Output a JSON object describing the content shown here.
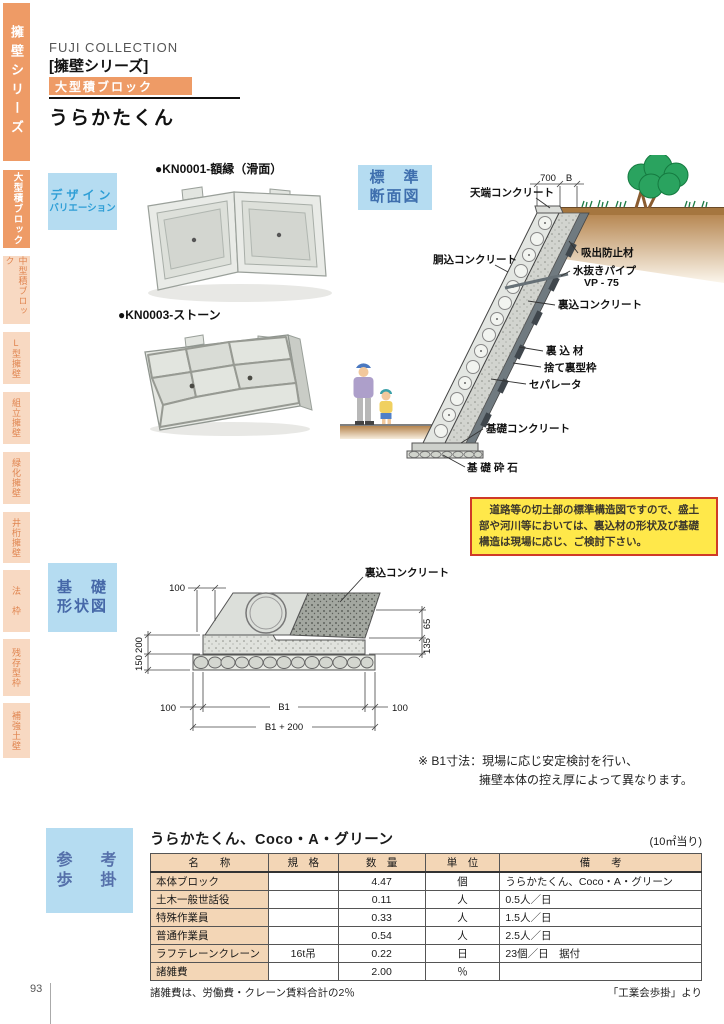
{
  "page": {
    "number": "93"
  },
  "sidebar": {
    "series": "擁壁シリーズ",
    "tabs": [
      {
        "label": "大型積ブロック",
        "active": true
      },
      {
        "label": "中型積ブロック",
        "active": false
      },
      {
        "label": "L型擁壁",
        "active": false
      },
      {
        "label": "組立擁壁",
        "active": false
      },
      {
        "label": "緑化擁壁",
        "active": false
      },
      {
        "label": "井桁擁壁",
        "active": false
      },
      {
        "label": "法　枠",
        "active": false
      },
      {
        "label": "残存型枠",
        "active": false
      },
      {
        "label": "補強土壁",
        "active": false
      }
    ]
  },
  "header": {
    "brand": "FUJI COLLECTION",
    "series": "[擁壁シリーズ]",
    "badge": "大型積ブロック",
    "title": "うらかたくん"
  },
  "design": {
    "label_line1": "デザイン",
    "label_line2": "バリエーション",
    "product1": "●KN0001-額縁（滑面）",
    "product2": "●KN0003-ストーン"
  },
  "cross_section": {
    "label_line1": "標　準",
    "label_line2": "断面図",
    "dims": {
      "top_width": "700",
      "b": "B"
    },
    "labels": {
      "tenba": "天端コンクリート",
      "dokome": "胴込コンクリート",
      "kyushutsu": "吸出防止材",
      "mizunuki": "水抜きパイプ",
      "vp": "VP - 75",
      "urakome_concrete": "裏込コンクリート",
      "urakome_material": "裏 込 材",
      "sute_urakata": "捨て裏型枠",
      "separator": "セパレータ",
      "kiso_concrete": "基礎コンクリート",
      "kiso_saiseki": "基 礎 砕 石"
    },
    "note": "　道路等の切土部の標準構造図ですので、盛土部や河川等においては、裏込材の形状及び基礎構造は現場に応じ、ご検討下さい。"
  },
  "foundation": {
    "label_line1": "基　礎",
    "label_line2": "形状図",
    "labels": {
      "urakome_concrete": "裏込コンクリート"
    },
    "dims": {
      "top100": "100",
      "left200": "200",
      "left150": "150",
      "right65": "65",
      "right135": "135",
      "bottom100L": "100",
      "b1": "B1",
      "bottom100R": "100",
      "b1_200": "B1 + 200"
    },
    "note_line1": "※ B1寸法：現場に応じ安定検討を行い、",
    "note_line2": "擁壁本体の控え厚によって異なります。"
  },
  "reference": {
    "label_line1": "参　考",
    "label_line2": "歩　掛",
    "table": {
      "title": "うらかたくん、Coco・A・グリーン",
      "unit_note": "(10㎡当り)",
      "headers": [
        "名　　称",
        "規　格",
        "数　量",
        "単　位",
        "備　　考"
      ],
      "rows": [
        [
          "本体ブロック",
          "",
          "4.47",
          "個",
          "うらかたくん、Coco・A・グリーン"
        ],
        [
          "土木一般世話役",
          "",
          "0.11",
          "人",
          "0.5人／日"
        ],
        [
          "特殊作業員",
          "",
          "0.33",
          "人",
          "1.5人／日"
        ],
        [
          "普通作業員",
          "",
          "0.54",
          "人",
          "2.5人／日"
        ],
        [
          "ラフテレーンクレーン",
          "16t吊",
          "0.22",
          "日",
          "23個／日　据付"
        ],
        [
          "諸雑費",
          "",
          "2.00",
          "％",
          ""
        ]
      ]
    },
    "footnote_left": "諸雑費は、労働費・クレーン賃料合計の2％",
    "footnote_right": "「工業会歩掛」より"
  }
}
